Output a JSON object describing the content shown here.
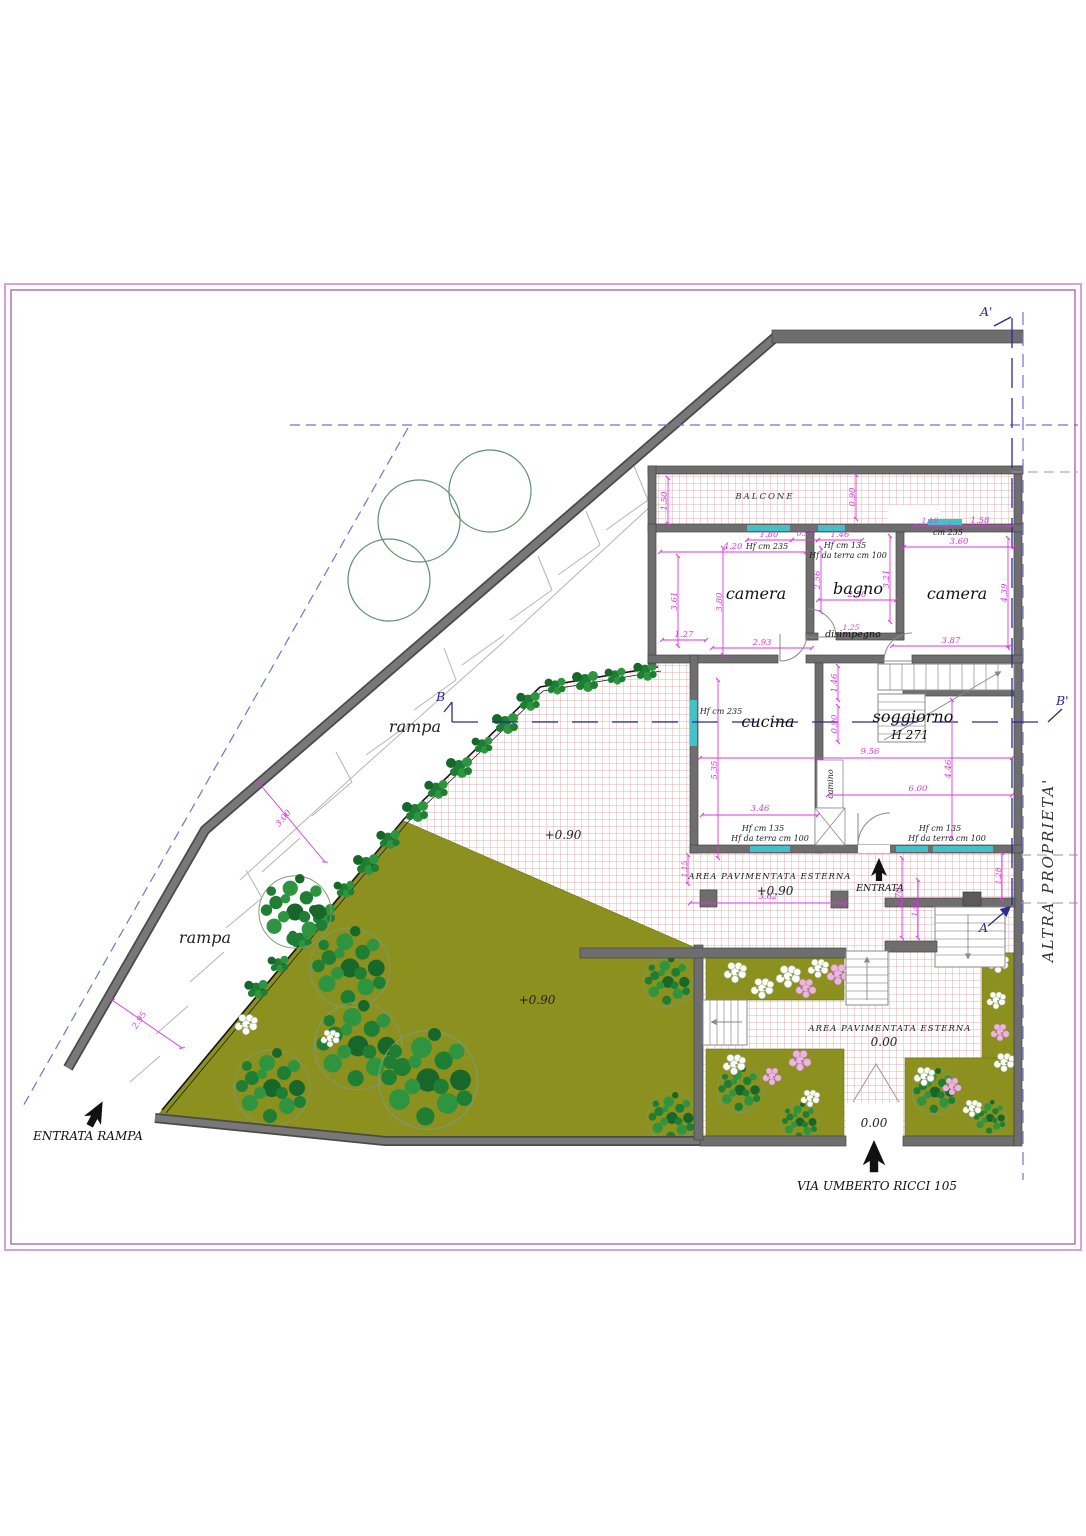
{
  "plan": {
    "type": "architectural site/floor plan",
    "street_label": "VIA UMBERTO RICCI 105"
  },
  "labels": {
    "balcone": "BALCONE",
    "camera": "camera",
    "bagno": "bagno",
    "disimpegno": "disimpegno",
    "cucina": "cucina",
    "soggiorno": "soggiorno",
    "soggiorno_h": "H 271",
    "camino": "camino",
    "rampa": "rampa",
    "entrata": "ENTRATA",
    "entrata_rampa": "ENTRATA RAMPA",
    "via": "VIA UMBERTO RICCI 105",
    "altra": "ALTRA PROPRIETA'",
    "area_pav": "AREA PAVIMENTATA ESTERNA",
    "lv090": "+0.90",
    "lv000": "0.00",
    "a1": "A'",
    "a": "A",
    "b": "B",
    "b1": "B'"
  },
  "heights": {
    "hf235": "Hf cm 235",
    "hf135": "Hf cm 135",
    "hf100": "Hf da terra cm 100",
    "cm235": "cm 235"
  },
  "dims": {
    "d150": "1.50",
    "d090": "0.90",
    "d180": "1.80",
    "d057": "0.57",
    "d146": "1.46",
    "d420": "4.20",
    "d110": "1.10",
    "d158": "1.58",
    "d360": "3.60",
    "d361": "3.61",
    "d380": "3.80",
    "d256": "2.56",
    "d250": "2.50",
    "d321": "3.21",
    "d439": "4.39",
    "d127": "1.27",
    "d293": "2.93",
    "d125": "1.25",
    "d387": "3.87",
    "d535": "5.35",
    "d956": "9.56",
    "d446": "4.46",
    "d600": "6.00",
    "d346": "3.46",
    "d115": "1.15",
    "d362": "3.62",
    "d270": "2.70",
    "d142": "1.42",
    "d128": "1.28",
    "d295": "2.95",
    "d300": "3.00"
  },
  "colors": {
    "wall": "#6e6e6e",
    "hatch_line": "#d4888a",
    "garden": "#8b901f",
    "tree_green": "#1e7e33",
    "dimension": "#e233e2",
    "window": "#45c0c4",
    "boundary_dash": "#7272d2",
    "section_blue": "#2828b8",
    "frame_outer": "#d9a0d9",
    "frame_inner": "#9c4f9c",
    "flower_pink": "#eab6e0",
    "flower_white": "#ffffff"
  }
}
